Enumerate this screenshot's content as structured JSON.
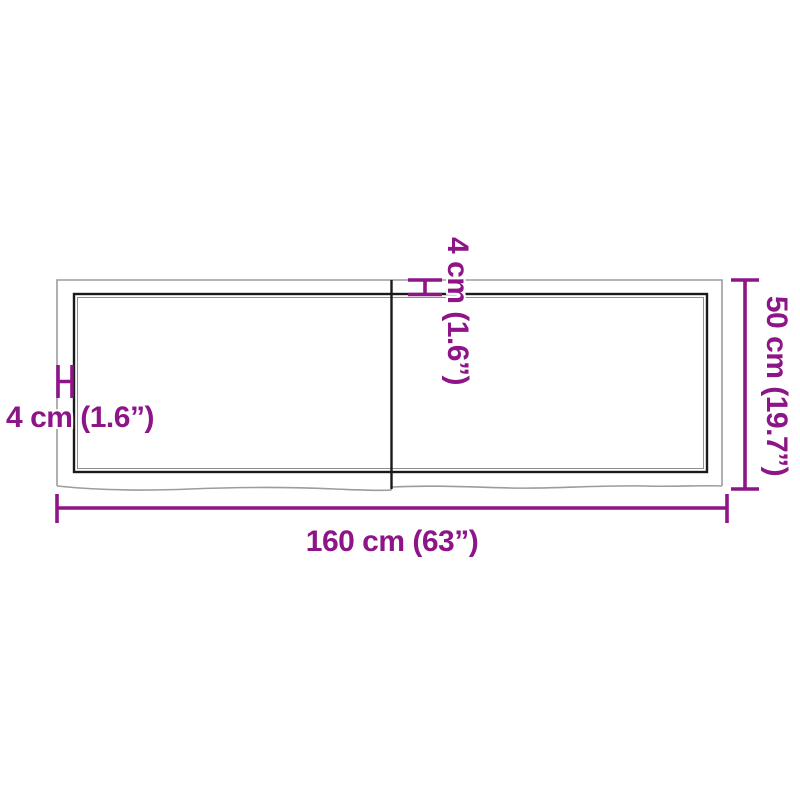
{
  "diagram": {
    "kind": "product-dimension-drawing",
    "subject": "wooden table top with live edge, two planks",
    "labels": {
      "width": "160 cm (63”)",
      "depth": "50 cm (19.7”)",
      "thickness_left": "4 cm (1.6”)",
      "thickness_top": "4 cm (1.6”)"
    },
    "colors": {
      "dimension": "#8E1588",
      "outline_outer": "#9C9C9C",
      "outline_inner": "#1A1A1A",
      "background": "#FFFFFF"
    }
  }
}
